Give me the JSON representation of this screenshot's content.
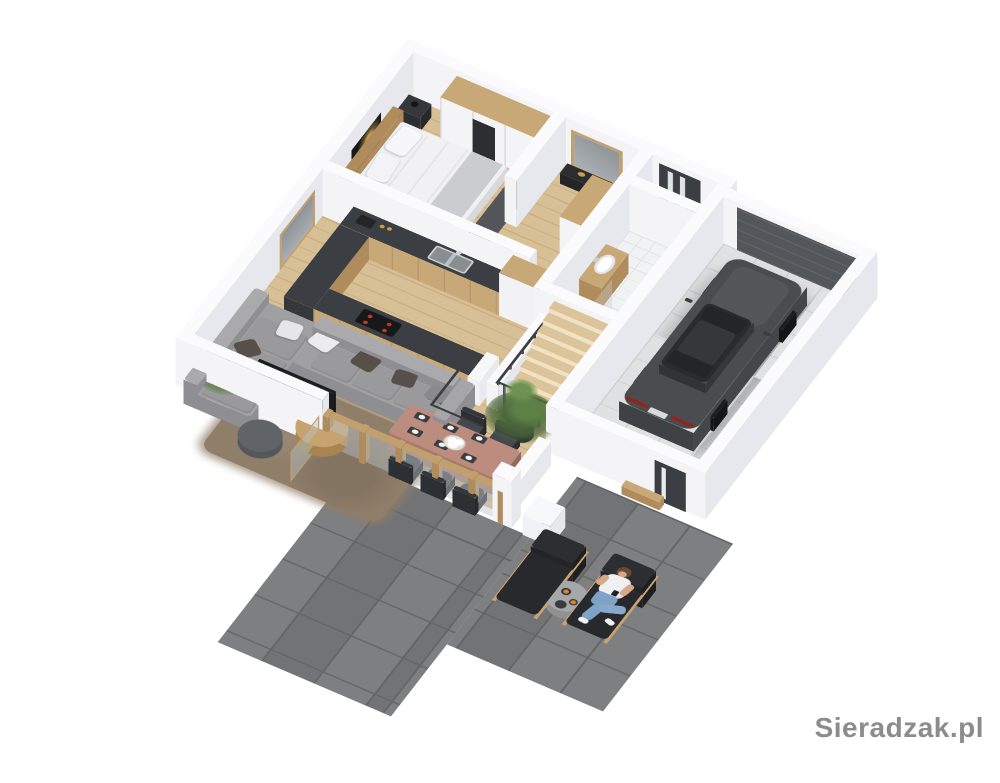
{
  "watermark": {
    "text": "Sieradzak.pl"
  },
  "scene": {
    "type": "isometric-3d-floor-plan-render",
    "floor": "ground-floor-cutaway",
    "rooms": [
      {
        "name": "bedroom",
        "objects": [
          "double-bed",
          "headboard",
          "pillows",
          "wardrobe",
          "nightstand",
          "wall-art",
          "dark-rug"
        ]
      },
      {
        "name": "hallway",
        "objects": [
          "framed-mirror",
          "console",
          "tall-cabinet"
        ]
      },
      {
        "name": "entry",
        "objects": [
          "front-door"
        ]
      },
      {
        "name": "bathroom",
        "objects": [
          "wood-washbasin-counter",
          "washbasin",
          "toilet",
          "shower"
        ]
      },
      {
        "name": "staircase",
        "objects": [
          "wooden-treads",
          "black-metal-railing",
          "knee-wall"
        ]
      },
      {
        "name": "kitchen",
        "objects": [
          "u-shaped-dark-counter",
          "wood-cabinets",
          "double-sink",
          "faucet",
          "cooktop",
          "coffee-machine",
          "tall-column-cabinet"
        ]
      },
      {
        "name": "living-room",
        "objects": [
          "gray-corner-sofa",
          "throw-pillows",
          "shag-rug",
          "round-coffee-table",
          "dark-pouf",
          "tv",
          "tv-stand",
          "green-plant",
          "window"
        ]
      },
      {
        "name": "dining-area",
        "objects": [
          "dining-table",
          "six-dark-chairs",
          "place-settings",
          "flower-centerpiece",
          "potted-tree",
          "glass-wall",
          "sliding-glass-door"
        ]
      },
      {
        "name": "garage",
        "objects": [
          "dark-coupe-car",
          "sectional-garage-door",
          "side-door",
          "tiled-floor",
          "wood-bench"
        ]
      },
      {
        "name": "terrace",
        "objects": [
          "two-sun-loungers",
          "round-side-table",
          "candles",
          "seated-person",
          "white-cube-seat",
          "large-gray-tiles"
        ]
      }
    ],
    "palette": {
      "wall_cap": "#fbfbfd",
      "wall_face": "#f4f4f7",
      "wall_side": "#e7e8ed",
      "wood_floor": "#d8c096",
      "wood_floor_line": "#c9ae82",
      "wood_cabinet": "#c9a878",
      "wood_dark": "#b08c5c",
      "wood_frame": "#c2a06e",
      "counter_dark": "#3b3e42",
      "steel": "#b9bec2",
      "sofa": "#a0a0a3",
      "sofa_dark": "#8f8f93",
      "pillow_dark": "#57504a",
      "rug_brown": "#8f7e6a",
      "rug_dark": "#53555a",
      "terrace": "#797a7c",
      "terrace_line": "#646567",
      "garage_floor": "#dfe1e3",
      "garage_line": "#ced1d4",
      "car_body": "#4a4c4f",
      "car_glass": "#232529",
      "car_shadow": "rgba(0,0,0,0.20)",
      "door_dark": "#3b3e42",
      "garage_door": "#53565a",
      "glass": "rgba(185,196,200,0.45)",
      "mirror_glass": "#9aa0a6",
      "green_dark": "#49663a",
      "green": "#5d8046",
      "green_light": "#6e9350",
      "bed_white": "#eff0f3",
      "blanket": "#cbccd0",
      "table_rose": "#bc8d7f",
      "table_rose_side": "#a87a6d",
      "chair_dark": "#45484d",
      "chair_back": "#33363a",
      "lounger_dark": "#27292c",
      "lounger_wood": "#c8a470",
      "red": "#c0392b",
      "taillight": "#8e2620",
      "flame": "#dd8a2e",
      "skin": "#d8a988",
      "jeans": "#7fa3c6",
      "shirt": "#eef0f2",
      "hair": "#6b4a33",
      "bath_tile": "#f0f2f4",
      "watermark": "#8c8c8c",
      "gold": "#c9a14e",
      "art_black": "#17181a"
    }
  }
}
